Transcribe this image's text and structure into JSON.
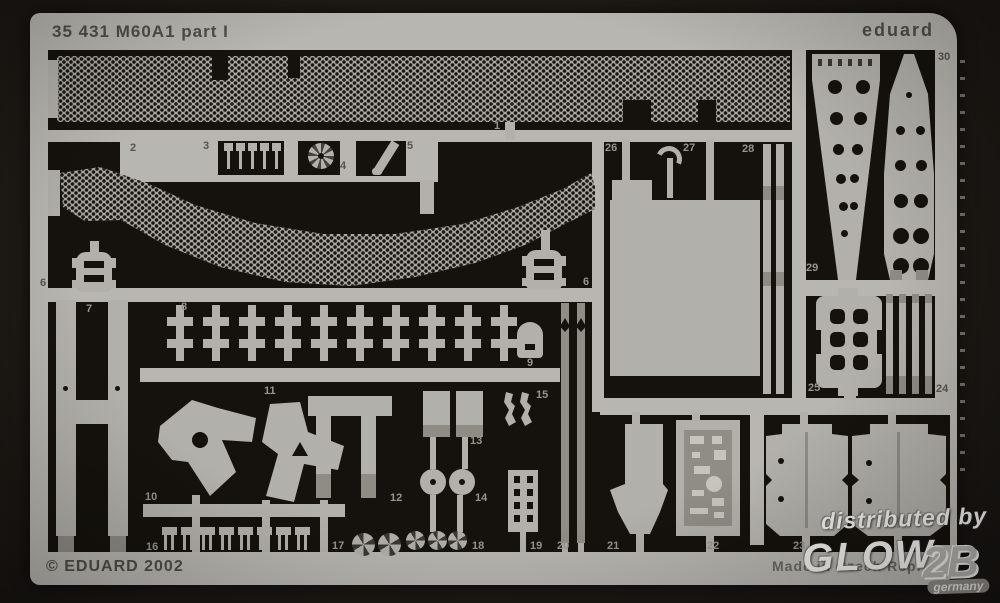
{
  "sheet": {
    "title": "35 431 M60A1  part I",
    "brand": "eduard",
    "copyright": "© EDUARD 2002",
    "made_in": "Made in Czech Rep.",
    "colors": {
      "fret": "#b8b6b0",
      "metal": "#b2b0aa",
      "cutout": "#15120d",
      "background": "#1e1a15"
    }
  },
  "part_labels": {
    "p1": "1",
    "p2": "2",
    "p3": "3",
    "p4": "4",
    "p5": "5",
    "p6": "6",
    "p6b": "6",
    "p7": "7",
    "p8": "8",
    "p9": "9",
    "p10": "10",
    "p11": "11",
    "p12": "12",
    "p13": "13",
    "p14": "14",
    "p15": "15",
    "p16": "16",
    "p17": "17",
    "p18": "18",
    "p19": "19",
    "p20": "20",
    "p21": "21",
    "p22": "22",
    "p23": "23",
    "p24": "24",
    "p25": "25",
    "p26": "26",
    "p27": "27",
    "p28": "28",
    "p29": "29",
    "p30": "30"
  },
  "watermark": {
    "distributed": "distributed by",
    "logo_main": "GLOW",
    "logo_suffix": "2B",
    "country": "germany"
  }
}
